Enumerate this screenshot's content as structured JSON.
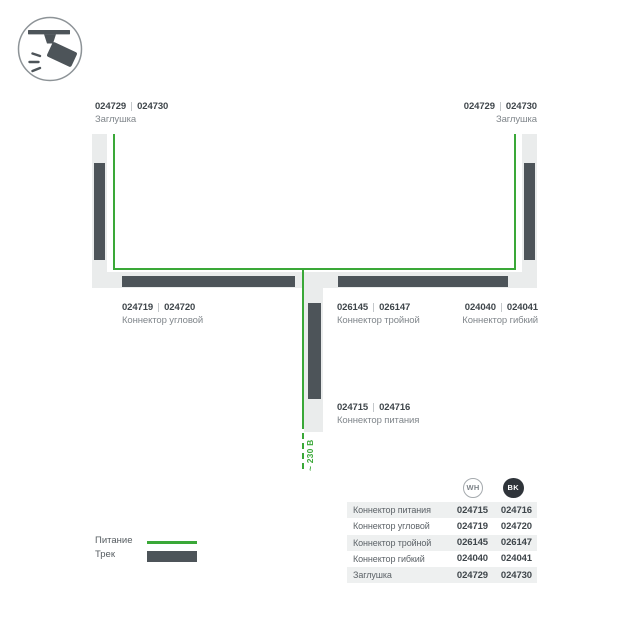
{
  "colors": {
    "track_dark": "#4d5459",
    "strip_light": "#eaecec",
    "power_green": "#3aa838",
    "number_text": "#3f464b",
    "name_text": "#80868b",
    "row_bg": "#eef0f0",
    "bk_badge": "#2f343a"
  },
  "header_icon": "track-spotlight-icon",
  "diagram": {
    "voltage_label": "~ 230 В",
    "labels": {
      "cap_left": {
        "wh": "024729",
        "bk": "024730",
        "name": "Заглушка"
      },
      "cap_right": {
        "wh": "024729",
        "bk": "024730",
        "name": "Заглушка"
      },
      "corner": {
        "wh": "024719",
        "bk": "024720",
        "name": "Коннектор угловой"
      },
      "tee": {
        "wh": "026145",
        "bk": "026147",
        "name": "Коннектор тройной"
      },
      "flex": {
        "wh": "024040",
        "bk": "024041",
        "name": "Коннектор гибкий"
      },
      "power": {
        "wh": "024715",
        "bk": "024716",
        "name": "Коннектор питания"
      }
    }
  },
  "legend": {
    "power": "Питание",
    "track": "Трек"
  },
  "table": {
    "columns": {
      "wh": "WH",
      "bk": "BK"
    },
    "rows": [
      {
        "name": "Коннектор питания",
        "wh": "024715",
        "bk": "024716"
      },
      {
        "name": "Коннектор угловой",
        "wh": "024719",
        "bk": "024720"
      },
      {
        "name": "Коннектор тройной",
        "wh": "026145",
        "bk": "026147"
      },
      {
        "name": "Коннектор гибкий",
        "wh": "024040",
        "bk": "024041"
      },
      {
        "name": "Заглушка",
        "wh": "024729",
        "bk": "024730"
      }
    ]
  }
}
